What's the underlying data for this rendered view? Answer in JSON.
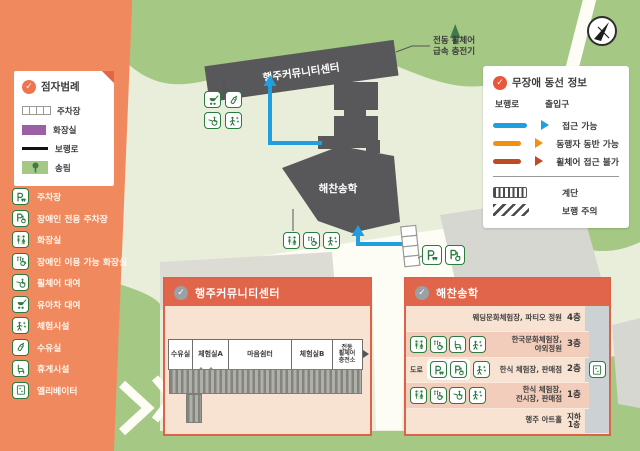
{
  "title": {
    "line1": "행주",
    "line2": "커뮤니티센터"
  },
  "colors": {
    "sidebar_orange": "#f08a5e",
    "panel_header": "#e0654a",
    "accessible_blue": "#1f9fe0",
    "companion_orange": "#f29111",
    "no_wheelchair_red": "#bf4a26",
    "toilet_purple": "#9a5fa5",
    "forest_green": "#a5c885",
    "building_gray": "#58585a",
    "icon_green": "#2b7a3f"
  },
  "braille_legend": {
    "title": "점자범례",
    "items": [
      {
        "label": "주차장"
      },
      {
        "label": "화장실"
      },
      {
        "label": "보행로"
      },
      {
        "label": "송림"
      }
    ]
  },
  "facilities": [
    {
      "icon": "parking-icon",
      "label": "주차장"
    },
    {
      "icon": "accessible-parking-icon",
      "label": "장애인 전용 주차장"
    },
    {
      "icon": "restroom-icon",
      "label": "화장실"
    },
    {
      "icon": "accessible-restroom-icon",
      "label": "장애인 이용 가능 화장실"
    },
    {
      "icon": "wheelchair-rental-icon",
      "label": "휠체어 대여"
    },
    {
      "icon": "stroller-rental-icon",
      "label": "유아차 대여"
    },
    {
      "icon": "experience-icon",
      "label": "체험시설"
    },
    {
      "icon": "nursing-room-icon",
      "label": "수유실"
    },
    {
      "icon": "rest-area-icon",
      "label": "휴게시설"
    },
    {
      "icon": "elevator-icon",
      "label": "엘리베이터"
    }
  ],
  "route_legend": {
    "title": "무장애 동선 정보",
    "path_header": "보행로",
    "entrance_header": "출입구",
    "routes": [
      {
        "label": "접근 가능",
        "color": "#1f9fe0"
      },
      {
        "label": "동행자 동반 가능",
        "color": "#f29111"
      },
      {
        "label": "휠체어 접근 불가",
        "color": "#bf4a26"
      }
    ],
    "stairs_label": "계단",
    "caution_label": "보행 주의"
  },
  "map": {
    "building1_label": "행주커뮤니티센터",
    "building2_label": "해찬송학",
    "charger_line1": "전동 휠체어",
    "charger_line2": "급속 충전기"
  },
  "center_panel": {
    "title": "행주커뮤니티센터",
    "rooms": [
      {
        "name": "수유실"
      },
      {
        "name": "체험실A"
      },
      {
        "name": "마음쉼터"
      },
      {
        "name": "체험실B"
      },
      {
        "name": "전동\n휠체어\n충전소"
      }
    ]
  },
  "building_panel": {
    "title": "해찬송학",
    "road_label": "도로",
    "floors": [
      {
        "name": "웨딩문화체험장, 파티오 정원",
        "floor": "4층"
      },
      {
        "name": "한국문화체험장,\n야외정원",
        "floor": "3층"
      },
      {
        "name": "한식 체험장, 판매점",
        "floor": "2층"
      },
      {
        "name": "한식 체험장,\n전시장, 판매점",
        "floor": "1층"
      },
      {
        "name": "행주 아트홀",
        "floor": "지하\n1층"
      }
    ]
  }
}
